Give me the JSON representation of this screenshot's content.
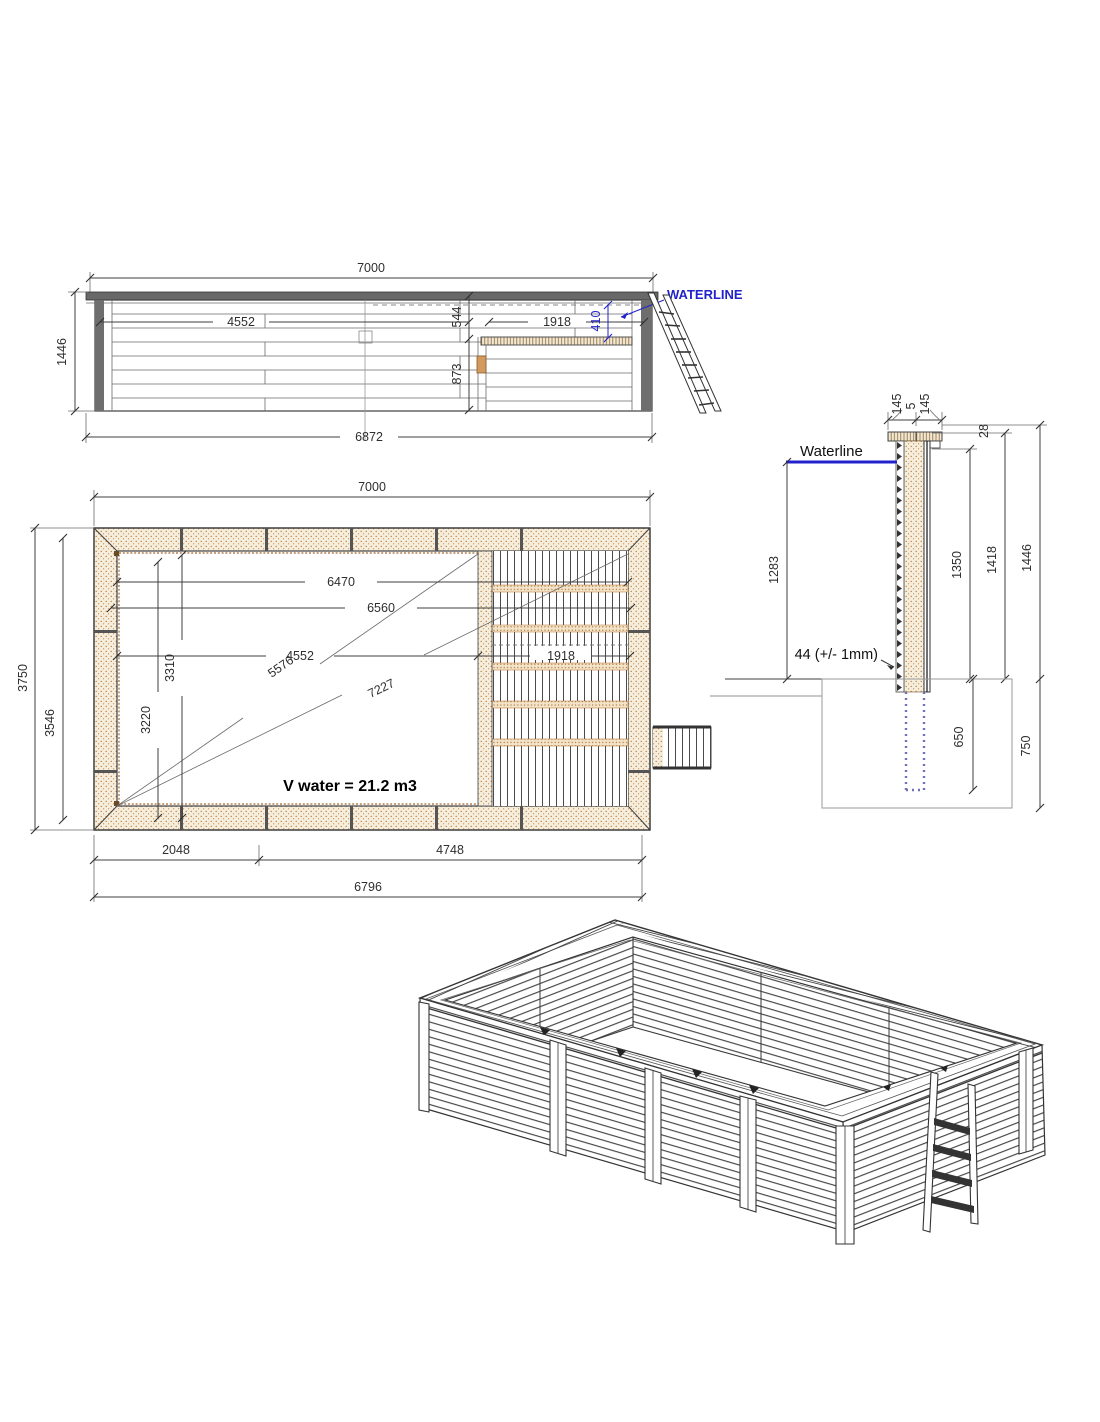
{
  "colors": {
    "accent_blue": "#2222cc",
    "wood_dot": "#b97a3e",
    "wood_fill": "#f6eedd",
    "line_dark": "#3f3f3f"
  },
  "elevation": {
    "dim_total_width": "7000",
    "dim_height": "1446",
    "dim_base": "6872",
    "dim_inner": "4552",
    "dim_top_to_bench": "544",
    "dim_bench_depth": "873",
    "dim_bench_width": "1918",
    "dim_waterline_to_bench": "410",
    "waterline_label": "WATERLINE"
  },
  "plan": {
    "dim_total_width": "7000",
    "dim_outer_height": "3750",
    "dim_inner_height": "3546",
    "dim_len1": "6470",
    "dim_len2": "6560",
    "dim_len3": "4552",
    "dim_bench": "1918",
    "dim_diag_short": "5576",
    "dim_diag_long": "7227",
    "dim_v1": "3310",
    "dim_v2": "3220",
    "dim_b1": "2048",
    "dim_b2": "4748",
    "dim_b3": "6796",
    "volume_label": "V water = 21.2 m3"
  },
  "section": {
    "waterline_label": "Waterline",
    "dim_cap_left": "145",
    "dim_cap_gap": "5",
    "dim_cap_right": "145",
    "dim_cap_thick": "28",
    "dim_water_depth": "1283",
    "dim_wall_inner": "1350",
    "dim_wall_mid": "1418",
    "dim_wall_total": "1446",
    "plank_note": "44 (+/- 1mm)",
    "dim_post_buried": "650",
    "dim_foundation": "750"
  }
}
